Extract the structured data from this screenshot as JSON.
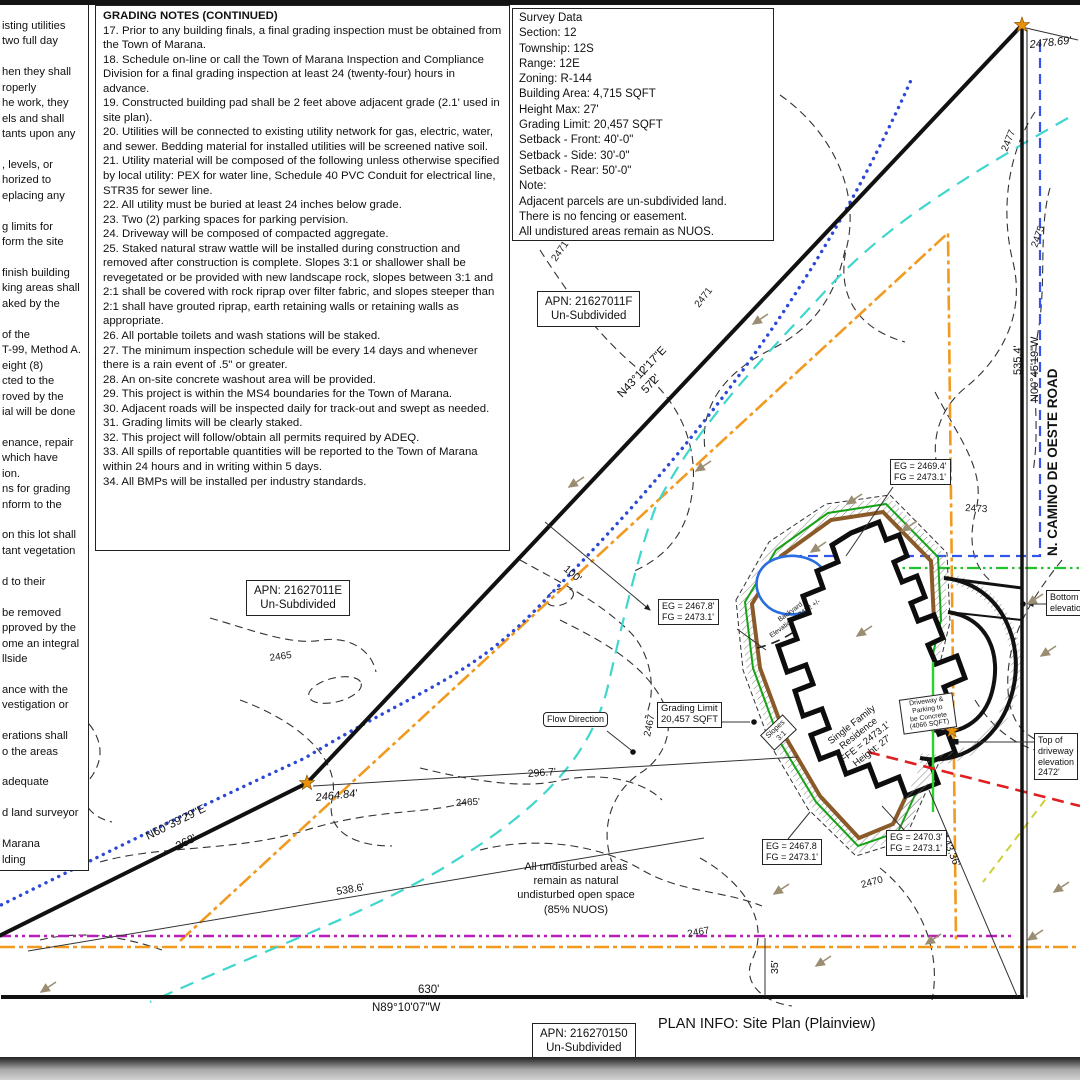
{
  "title_block": {
    "plan_info": "PLAN INFO: Site Plan (Plainview)"
  },
  "left_notes_partial": {
    "lines": [
      "isting utilities",
      "two full day",
      "",
      "hen they shall",
      "roperly",
      "he work, they",
      "els and shall",
      "tants upon any",
      "",
      ", levels, or",
      "horized to",
      "eplacing any",
      "",
      "g limits for",
      "form the site",
      "",
      "finish building",
      "king areas shall",
      "aked by the",
      "",
      "of the",
      "T-99, Method A.",
      "eight (8)",
      "cted to the",
      "roved by the",
      "ial will be done",
      "",
      "enance, repair",
      "which have",
      "ion.",
      "ns for grading",
      "nform to the",
      "",
      "on this lot shall",
      "tant vegetation",
      "",
      "d to their",
      "",
      "be removed",
      "pproved by the",
      "ome an integral",
      "llside",
      "",
      "ance with the",
      "vestigation or",
      "",
      "erations shall",
      "o the areas",
      "",
      "adequate",
      "",
      "d land surveyor",
      "",
      "Marana",
      "lding"
    ]
  },
  "grading_notes": {
    "title": "GRADING NOTES (CONTINUED)",
    "items": [
      "17. Prior to any building finals, a final grading inspection must be obtained from the Town of Marana.",
      "18. Schedule on-line or call the Town of Marana Inspection and Compliance Division for a final grading inspection at least 24 (twenty-four) hours in advance.",
      "19. Constructed building pad shall be 2 feet above adjacent grade (2.1' used in site plan).",
      "20. Utilities will be connected to existing utility network for gas, electric, water, and sewer. Bedding material for installed utilities will be screened native soil.",
      "21. Utility material will be composed of the following unless otherwise specified by local utility: PEX for water line, Schedule 40 PVC Conduit for electrical line, STR35 for sewer line.",
      "22. All utility must be buried at least 24 inches below grade.",
      "23. Two (2) parking spaces for parking pervision.",
      "24. Driveway will be composed of compacted aggregate.",
      "25. Staked natural straw wattle will be installed during construction and removed after construction is complete. Slopes 3:1 or shallower shall be revegetated or be provided with new landscape rock, slopes between 3:1 and 2:1 shall be covered with rock riprap over filter fabric, and slopes steeper than 2:1 shall have grouted riprap, earth retaining walls or retaining walls as appropriate.",
      "26. All portable toilets and wash stations will be staked.",
      "27. The minimum inspection schedule will be every 14 days and whenever there is a rain event of .5\" or greater.",
      "28. An on-site concrete washout area will be provided.",
      "29. This project is within the MS4 boundaries for the Town of Marana.",
      "30. Adjacent roads will be inspected daily for track-out and swept as needed.",
      "31. Grading limits will be clearly staked.",
      "32. This project will follow/obtain all permits required by ADEQ.",
      "33. All spills of reportable quantities will be reported to the Town of Marana within 24 hours and in writing within 5 days.",
      "34. All BMPs will be installed per industry standards."
    ]
  },
  "survey_data": {
    "lines": [
      "Survey Data",
      "Section: 12",
      "Township: 12S",
      "Range: 12E",
      "Zoning: R-144",
      "Building Area: 4,715 SQFT",
      "Height Max: 27'",
      "Grading Limit: 20,457 SQFT",
      "Setback - Front: 40'-0\"",
      "Setback - Side: 30'-0\"",
      "Setback - Rear: 50'-0\"",
      "Note:",
      "Adjacent parcels are un-subdivided land.",
      "There is no fencing or easement.",
      "All undistured areas remain as NUOS."
    ]
  },
  "apn_boxes": [
    {
      "line1": "APN: 21627011F",
      "line2": "Un-Subdivided"
    },
    {
      "line1": "APN: 21627011E",
      "line2": "Un-Subdivided"
    },
    {
      "line1": "APN: 216270150",
      "line2": "Un-Subdivided"
    }
  ],
  "road_label": "N. CAMINO DE OESTE ROAD",
  "bearings": {
    "ne": "N43°12'17\"E",
    "sw": "N60°39'29\"E",
    "east": "N00°45'19\"W",
    "south": "N89°10'07\"W"
  },
  "dimensions": {
    "d572": "572'",
    "d268": "268'",
    "d535": "535.4'",
    "d630": "630'",
    "d100": "100'",
    "d296": "296.7'",
    "d538": "538.6'",
    "d143": "143.36'",
    "d35": "35'"
  },
  "spot_elevations": {
    "ne_corner": "2478.69'",
    "w_corner": "2464.84'"
  },
  "contour_labels": [
    "2471",
    "2469",
    "2465",
    "2463",
    "2465'",
    "2467",
    "2467",
    "2470",
    "2473",
    "2475",
    "2477",
    "2471"
  ],
  "callouts": {
    "eg1": [
      "EG = 2469.4'",
      "FG = 2473.1'"
    ],
    "eg2": [
      "EG = 2467.8'",
      "FG = 2473.1'"
    ],
    "grading_limit": [
      "Grading Limit",
      "20,457 SQFT"
    ],
    "flow": "Flow Direction",
    "eg3": [
      "EG = 2467.8",
      "FG = 2473.1'"
    ],
    "eg4": [
      "EG = 2470.3'",
      "FG = 2473.1'"
    ],
    "top_driveway": [
      "Top of",
      "driveway",
      "elevation",
      "2472'"
    ],
    "bottom_partial": [
      "Bottom of",
      "elevation"
    ],
    "driveway_concrete": [
      "Driveway &",
      "Parking to",
      "be Concrete",
      "(4066 SQFT)"
    ],
    "slopes": [
      "Slopes",
      "3:1"
    ],
    "single_family": [
      "Single Family",
      "Residence",
      "FFE = 2473.1'",
      "Height: 27'"
    ],
    "backyard": [
      "Backyard",
      "Elevation = 2472 +/-"
    ],
    "nuos": [
      "All undisturbed areas",
      "remain as natural",
      "undisturbed open space",
      "(85% NUOS)"
    ]
  },
  "colors": {
    "boundary": "#111111",
    "utility_dotted": "#2b48d8",
    "wash_cyan": "#3fd6cd",
    "blue_dash": "#3355ee",
    "green_limit": "#17a317",
    "brown_pad": "#8a5a28",
    "orange_limit": "#f09a20",
    "magenta_line": "#b81fb8",
    "red_line": "#e02020",
    "yellow_line": "#cfcf3a",
    "pond_blue": "#2a6de0",
    "star": "#e8920a",
    "arrow_tan": "#9b8d72"
  }
}
